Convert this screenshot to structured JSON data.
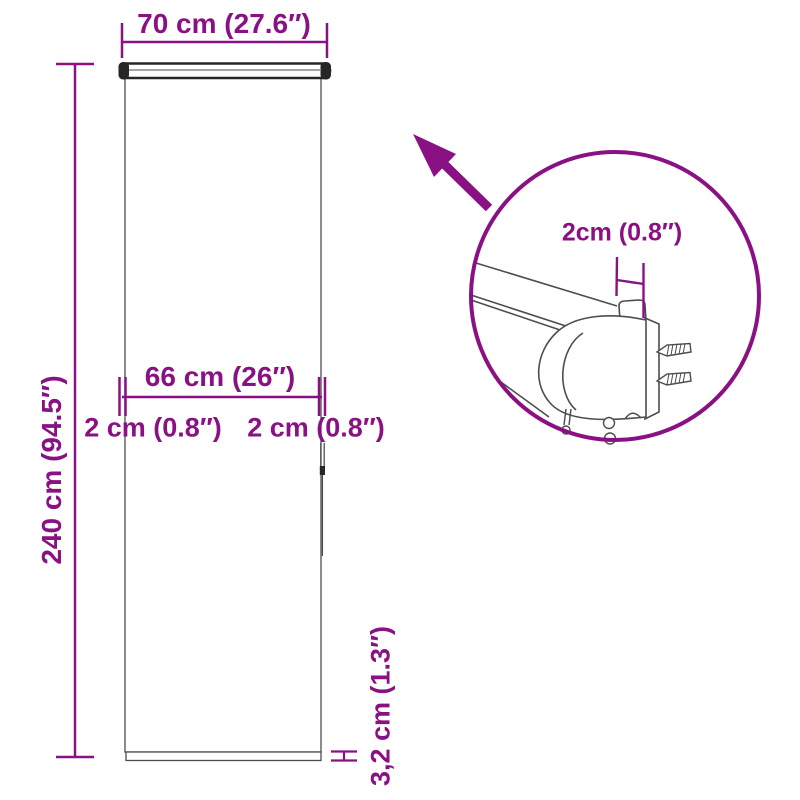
{
  "colors": {
    "accent": "#8a1183",
    "outline": "#4d4d4d",
    "dark": "#262626"
  },
  "diagram": {
    "labels": {
      "total_width": "70 cm (27.6″)",
      "total_height": "240 cm (94.5″)",
      "fabric_width": "66 cm (26″)",
      "left_gap": "2 cm (0.8″)",
      "right_gap": "2 cm (0.8″)",
      "bottom_bar_height": "3,2 cm (1.3″)",
      "detail_bracket_depth": "2cm (0.8″)"
    }
  }
}
